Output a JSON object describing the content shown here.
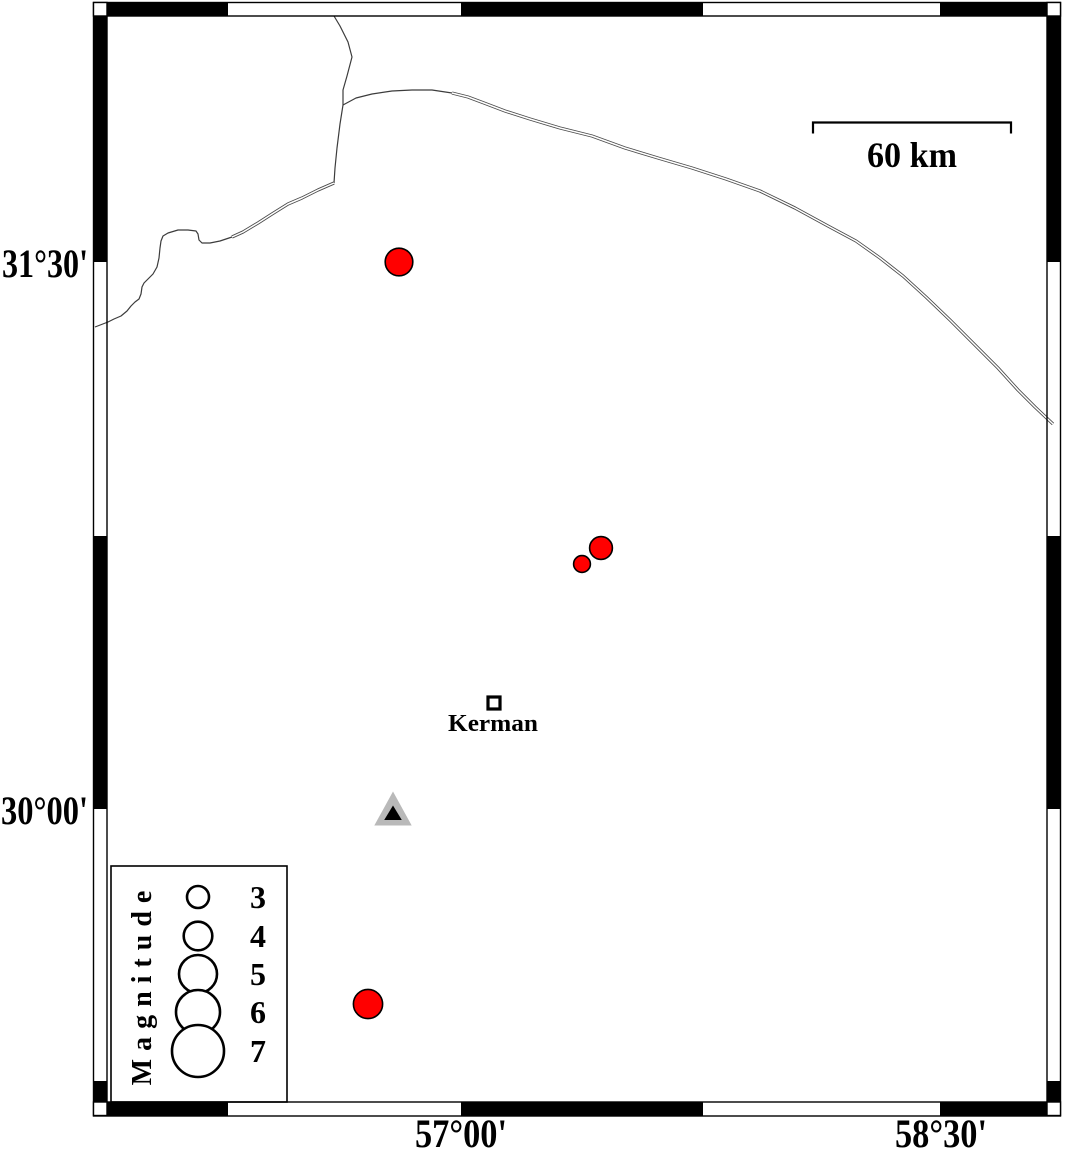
{
  "figure": {
    "kind": "seismicity-map-figure"
  },
  "axes": {
    "left_labels": [
      {
        "text": "31°30'"
      },
      {
        "text": "30°00'"
      }
    ],
    "bottom_labels": [
      {
        "text": "57°00'"
      },
      {
        "text": "58°30'"
      }
    ]
  },
  "frame": {
    "outer": [
      93.5,
      2.5,
      1060.5,
      1116
    ],
    "inner": [
      107,
      16,
      1047,
      1102
    ],
    "x_transitions": [
      107,
      228,
      461,
      703,
      940,
      1047
    ],
    "y_transitions": [
      16,
      262,
      536,
      809,
      1081,
      1102
    ]
  },
  "scale_bar": {
    "label": "60 km",
    "x1": 813,
    "x2": 1011,
    "y": 122.5,
    "tick_drop": 11
  },
  "city": {
    "label": "Kerman",
    "x": 494,
    "y": 703
  },
  "station": {
    "x": 393,
    "y": 812
  },
  "earthquakes": [
    {
      "x": 399,
      "y": 262,
      "r": 13.8
    },
    {
      "x": 601,
      "y": 548,
      "r": 11.4
    },
    {
      "x": 582,
      "y": 564,
      "r": 8.4
    },
    {
      "x": 368,
      "y": 1004,
      "r": 14.6
    }
  ],
  "legend": {
    "title": "Magnitude",
    "box": [
      111,
      866,
      287,
      1102
    ],
    "circle_cx": 198,
    "label_x": 258,
    "entries": [
      {
        "label": "3",
        "cy": 897,
        "r": 11
      },
      {
        "label": "4",
        "cy": 936,
        "r": 14.3
      },
      {
        "label": "5",
        "cy": 974,
        "r": 19
      },
      {
        "label": "6",
        "cy": 1012,
        "r": 22
      },
      {
        "label": "7",
        "cy": 1051,
        "r": 26
      }
    ]
  },
  "colors": {
    "background": "#ffffff",
    "earthquake_fill": "#ff0000",
    "marker_stroke": "#000000",
    "station_outer": "#b9b9b9",
    "station_inner": "#000000",
    "boundary_line": "#3c3c3c",
    "double_line_casing": "#4a4a4a",
    "frame_black": "#000000"
  },
  "map_lines": [
    {
      "name": "north-boundary",
      "style": "single",
      "points": [
        [
          334,
          16
        ],
        [
          340,
          26
        ],
        [
          348,
          42
        ],
        [
          352,
          57
        ],
        [
          347,
          76
        ],
        [
          343,
          90
        ],
        [
          343,
          105
        ],
        [
          340,
          124
        ],
        [
          337,
          148
        ],
        [
          335,
          168
        ],
        [
          334,
          183
        ]
      ]
    },
    {
      "name": "road-junction-head",
      "style": "single",
      "points": [
        [
          343,
          105
        ],
        [
          356,
          98
        ],
        [
          372,
          94
        ],
        [
          392,
          91
        ],
        [
          412,
          90
        ],
        [
          432,
          90
        ],
        [
          452,
          93
        ]
      ]
    },
    {
      "name": "road-northeast",
      "style": "double",
      "points": [
        [
          452,
          93
        ],
        [
          468,
          97
        ],
        [
          484,
          103
        ],
        [
          505,
          111
        ],
        [
          530,
          119
        ],
        [
          560,
          128
        ],
        [
          592,
          136
        ],
        [
          625,
          148
        ],
        [
          658,
          158
        ],
        [
          692,
          168
        ],
        [
          726,
          179
        ],
        [
          760,
          191
        ],
        [
          795,
          208
        ],
        [
          828,
          226
        ],
        [
          856,
          241
        ],
        [
          880,
          258
        ],
        [
          903,
          276
        ],
        [
          926,
          297
        ],
        [
          950,
          320
        ],
        [
          973,
          343
        ],
        [
          998,
          368
        ],
        [
          1018,
          390
        ],
        [
          1035,
          407
        ],
        [
          1053,
          424
        ]
      ]
    },
    {
      "name": "west-boundary-upper",
      "style": "double",
      "points": [
        [
          334,
          183
        ],
        [
          318,
          190
        ],
        [
          302,
          198
        ],
        [
          288,
          204
        ],
        [
          272,
          214
        ],
        [
          258,
          223
        ],
        [
          243,
          232
        ],
        [
          232,
          237
        ]
      ]
    },
    {
      "name": "west-boundary-lower",
      "style": "single",
      "points": [
        [
          232,
          237
        ],
        [
          220,
          241
        ],
        [
          210,
          243
        ],
        [
          202,
          243
        ],
        [
          199,
          240
        ],
        [
          198,
          234
        ],
        [
          196,
          231
        ],
        [
          188,
          230
        ],
        [
          178,
          230
        ],
        [
          168,
          233
        ],
        [
          163,
          236
        ],
        [
          161,
          241
        ],
        [
          160,
          248
        ],
        [
          159,
          258
        ],
        [
          157,
          267
        ],
        [
          153,
          274
        ],
        [
          148,
          279
        ],
        [
          144,
          283
        ],
        [
          142,
          287
        ],
        [
          141,
          294
        ],
        [
          139,
          299
        ],
        [
          135,
          302
        ],
        [
          131,
          306
        ],
        [
          127,
          311
        ],
        [
          121,
          316
        ],
        [
          114,
          319
        ],
        [
          108,
          322
        ],
        [
          95,
          327
        ]
      ]
    }
  ]
}
